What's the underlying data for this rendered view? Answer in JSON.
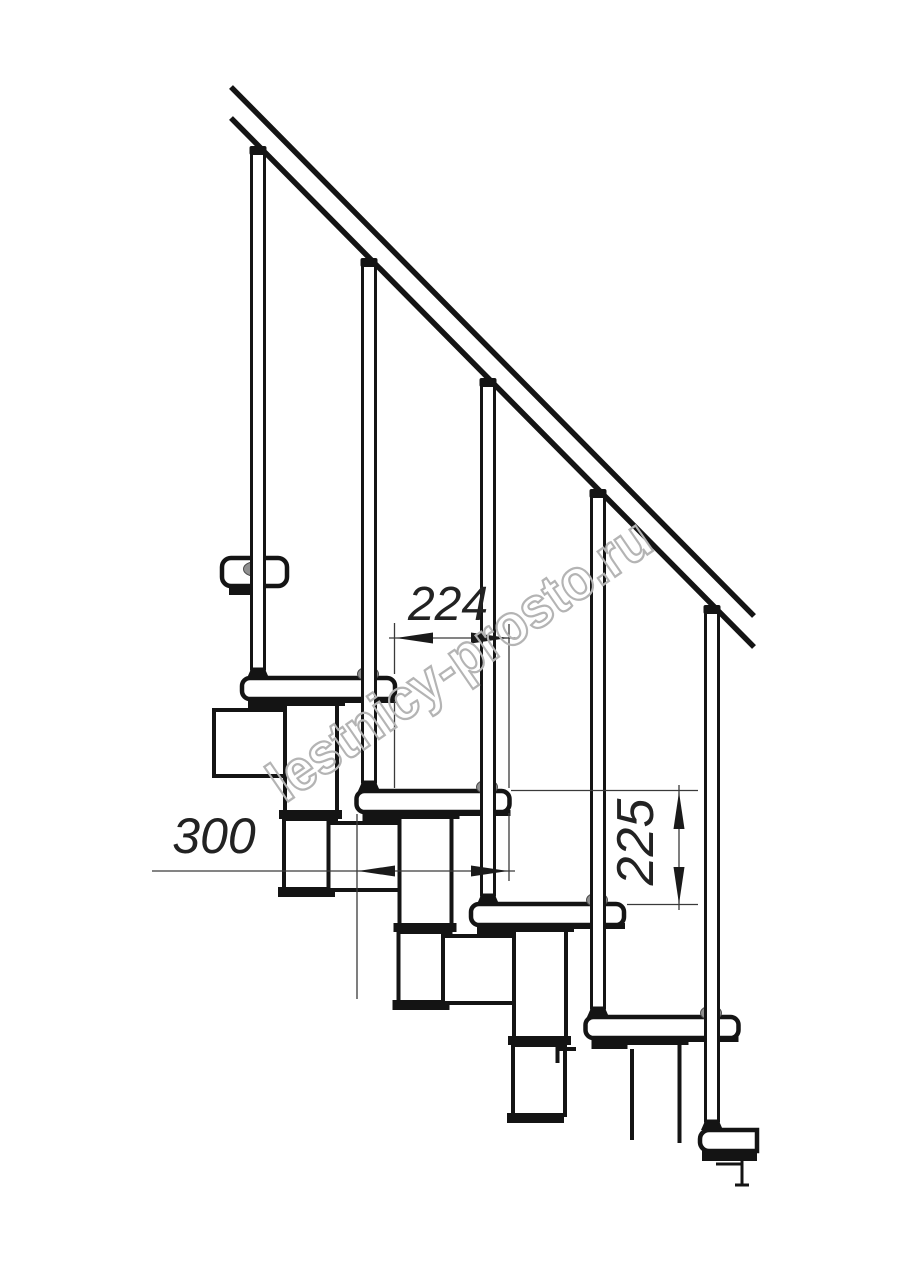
{
  "drawing": {
    "type": "technical-line-drawing",
    "subject": "modular staircase side elevation",
    "background": "#ffffff",
    "stroke_color": "#141414",
    "collar_color": "#8f8f8f",
    "visible_treads": 6,
    "visible_balusters": 5
  },
  "dimensions": [
    {
      "id": "going",
      "value": "224",
      "orientation": "horizontal"
    },
    {
      "id": "depth",
      "value": "300",
      "orientation": "horizontal"
    },
    {
      "id": "rise",
      "value": "225",
      "orientation": "vertical"
    }
  ],
  "watermark": {
    "text": "lestnicy-prosto.ru",
    "color": "#b4b4b4"
  }
}
